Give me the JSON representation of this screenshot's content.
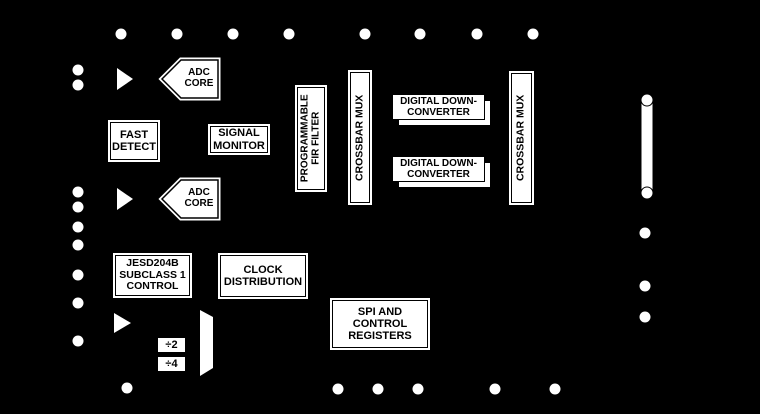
{
  "diagram_title": "ADC functional block diagram",
  "colors": {
    "background": "#000000",
    "block_fill": "#ffffff",
    "block_border": "#000000",
    "block_text": "#000000"
  },
  "blocks": {
    "adc_core_a": [
      "ADC",
      "CORE"
    ],
    "adc_core_b": [
      "ADC",
      "CORE"
    ],
    "fast_detect": [
      "FAST",
      "DETECT"
    ],
    "signal_monitor": [
      "SIGNAL",
      "MONITOR"
    ],
    "fir_filter": [
      "PROGRAMMABLE",
      "FIR FILTER"
    ],
    "crossbar_mux_1": [
      "CROSSBAR MUX"
    ],
    "ddc_1": [
      "DIGITAL DOWN-",
      "CONVERTER"
    ],
    "ddc_2": [
      "DIGITAL DOWN-",
      "CONVERTER"
    ],
    "crossbar_mux_2": [
      "CROSSBAR MUX"
    ],
    "jesd204b": [
      "JESD204B",
      "SUBCLASS 1",
      "CONTROL"
    ],
    "clock_distribution": [
      "CLOCK",
      "DISTRIBUTION"
    ],
    "divider_2": [
      "÷2"
    ],
    "divider_4": [
      "÷4"
    ],
    "spi": [
      "SPI AND",
      "CONTROL",
      "REGISTERS"
    ]
  }
}
